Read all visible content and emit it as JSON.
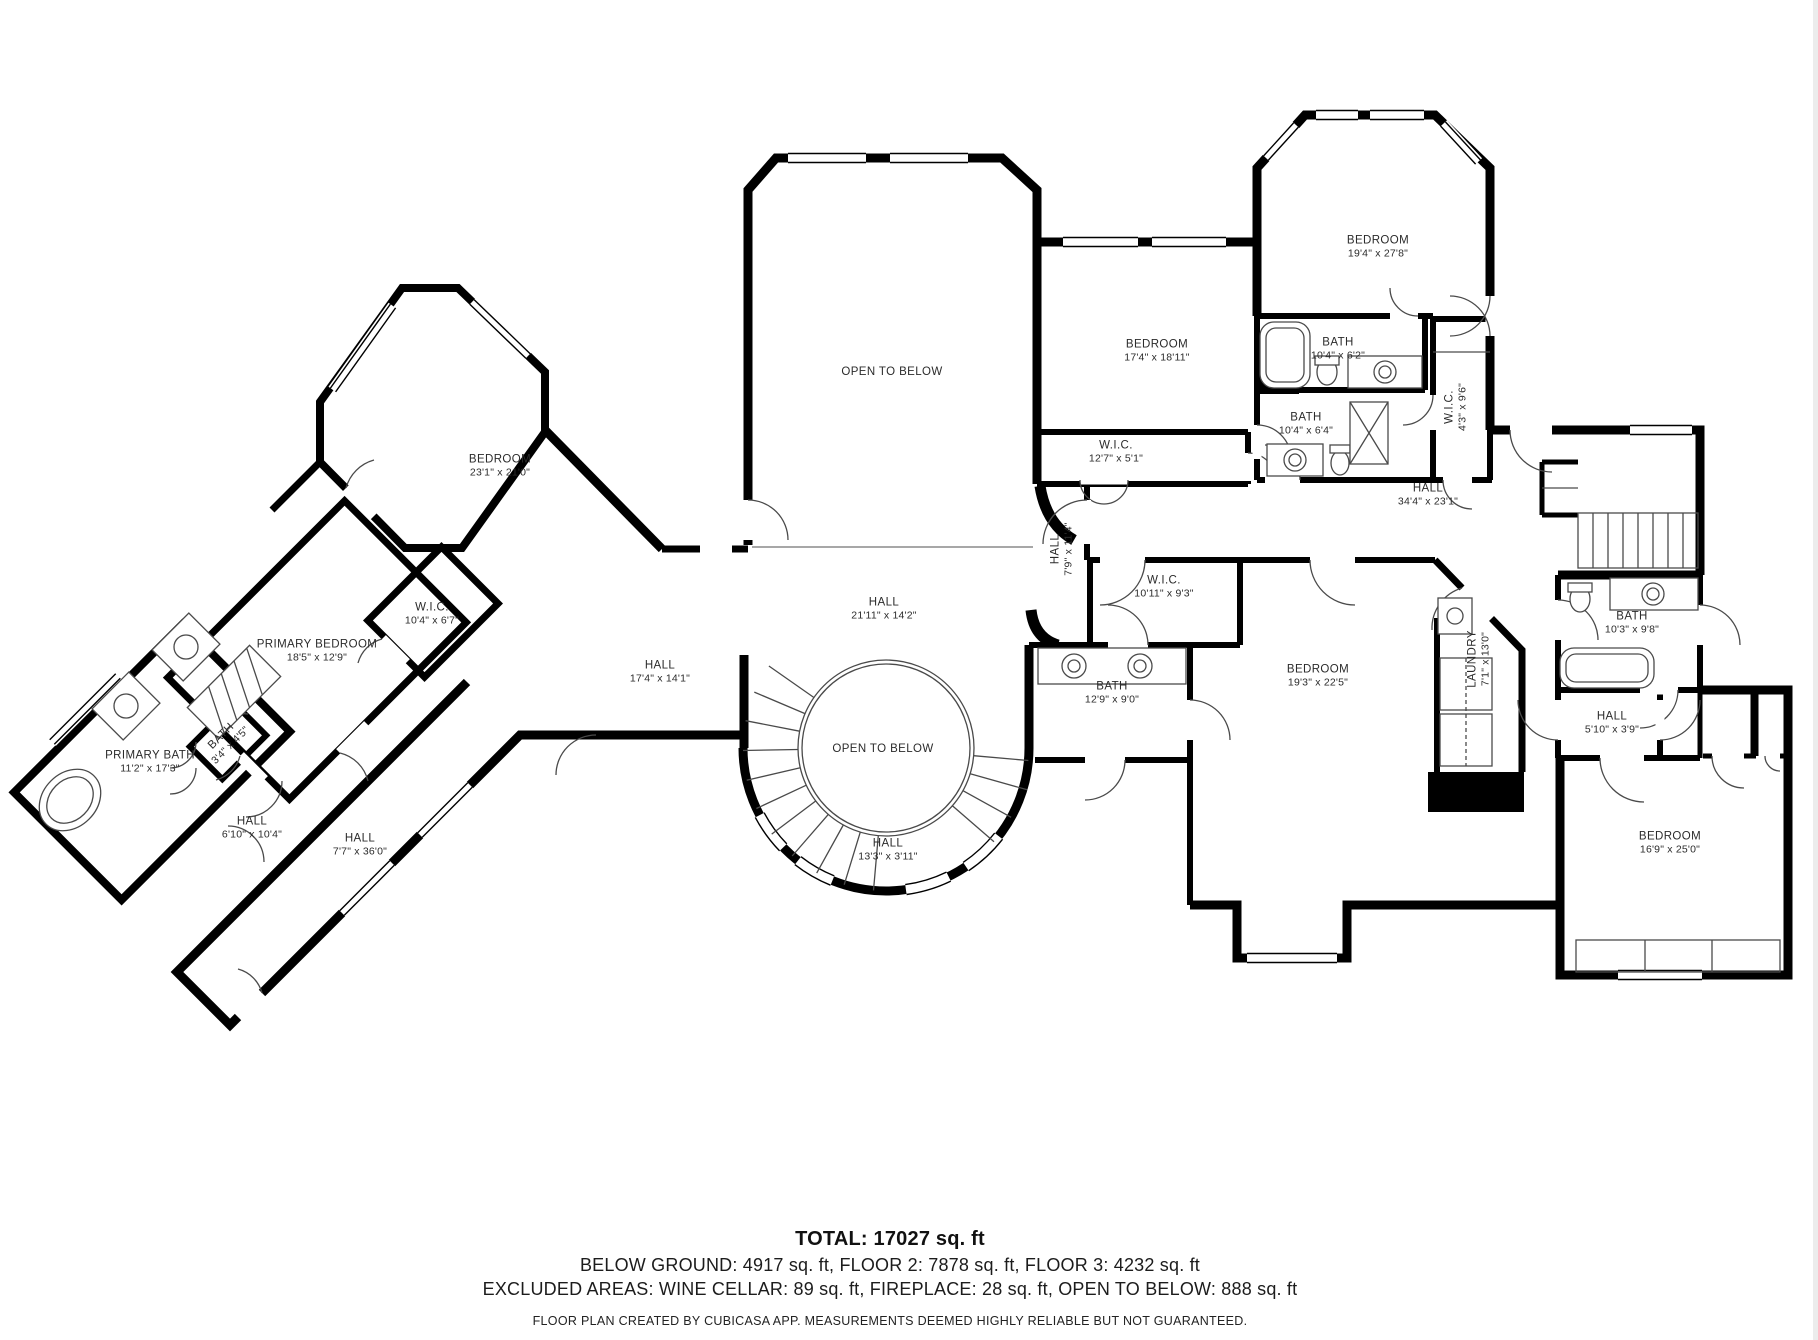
{
  "colors": {
    "wall": "#000000",
    "text": "#2b2b2b",
    "background": "#ffffff"
  },
  "footer": {
    "total": "TOTAL: 17027 sq. ft",
    "floors": "BELOW GROUND: 4917 sq. ft, FLOOR 2: 7878 sq. ft, FLOOR 3: 4232 sq. ft",
    "excluded": "EXCLUDED AREAS: WINE CELLAR: 89 sq. ft, FIREPLACE: 28 sq. ft, OPEN TO BELOW: 888 sq. ft",
    "disclaimer": "FLOOR PLAN CREATED BY CUBICASA APP. MEASUREMENTS DEEMED HIGHLY RELIABLE BUT NOT GUARANTEED."
  },
  "rooms": [
    {
      "name": "OPEN TO BELOW",
      "dims": "",
      "x": 892,
      "y": 372,
      "rot": 0
    },
    {
      "name": "BEDROOM",
      "dims": "19'4\" x 27'8\"",
      "x": 1378,
      "y": 247,
      "rot": 0
    },
    {
      "name": "BEDROOM",
      "dims": "17'4\" x 18'11\"",
      "x": 1157,
      "y": 351,
      "rot": 0
    },
    {
      "name": "BATH",
      "dims": "10'4\" x 6'2\"",
      "x": 1338,
      "y": 349,
      "rot": 0
    },
    {
      "name": "BATH",
      "dims": "10'4\" x 6'4\"",
      "x": 1306,
      "y": 424,
      "rot": 0
    },
    {
      "name": "W.I.C.",
      "dims": "4'3\" x 9'6\"",
      "x": 1456,
      "y": 407,
      "rot": -90
    },
    {
      "name": "W.I.C.",
      "dims": "12'7\" x 5'1\"",
      "x": 1116,
      "y": 452,
      "rot": 0
    },
    {
      "name": "HALL",
      "dims": "34'4\" x 23'1\"",
      "x": 1428,
      "y": 495,
      "rot": 0
    },
    {
      "name": "HALL",
      "dims": "7'9\" x 11'4\"",
      "x": 1062,
      "y": 549,
      "rot": -90
    },
    {
      "name": "W.I.C.",
      "dims": "10'11\" x 9'3\"",
      "x": 1164,
      "y": 587,
      "rot": 0
    },
    {
      "name": "BATH",
      "dims": "12'9\" x 9'0\"",
      "x": 1112,
      "y": 693,
      "rot": 0
    },
    {
      "name": "BEDROOM",
      "dims": "19'3\" x 22'5\"",
      "x": 1318,
      "y": 676,
      "rot": 0
    },
    {
      "name": "LAUNDRY",
      "dims": "7'1\" x 13'0\"",
      "x": 1479,
      "y": 659,
      "rot": -90
    },
    {
      "name": "BATH",
      "dims": "10'3\" x 9'8\"",
      "x": 1632,
      "y": 623,
      "rot": 0
    },
    {
      "name": "HALL",
      "dims": "5'10\" x 3'9\"",
      "x": 1612,
      "y": 723,
      "rot": 0
    },
    {
      "name": "BEDROOM",
      "dims": "16'9\" x 25'0\"",
      "x": 1670,
      "y": 843,
      "rot": 0
    },
    {
      "name": "BEDROOM",
      "dims": "23'1\" x 21'0\"",
      "x": 500,
      "y": 466,
      "rot": 0
    },
    {
      "name": "W.I.C.",
      "dims": "10'4\" x 6'7\"",
      "x": 432,
      "y": 614,
      "rot": 0
    },
    {
      "name": "PRIMARY BEDROOM",
      "dims": "18'5\" x 12'9\"",
      "x": 317,
      "y": 651,
      "rot": 0
    },
    {
      "name": "PRIMARY BATH",
      "dims": "11'2\" x 17'3\"",
      "x": 150,
      "y": 762,
      "rot": 0
    },
    {
      "name": "BATH",
      "dims": "3'4\" x 4'5\"",
      "x": 226,
      "y": 741,
      "rot": -45
    },
    {
      "name": "HALL",
      "dims": "6'10\" x 10'4\"",
      "x": 252,
      "y": 828,
      "rot": 0
    },
    {
      "name": "HALL",
      "dims": "7'7\" x 36'0\"",
      "x": 360,
      "y": 845,
      "rot": 0
    },
    {
      "name": "HALL",
      "dims": "17'4\" x 14'1\"",
      "x": 660,
      "y": 672,
      "rot": 0
    },
    {
      "name": "HALL",
      "dims": "21'11\" x 14'2\"",
      "x": 884,
      "y": 609,
      "rot": 0
    },
    {
      "name": "OPEN TO BELOW",
      "dims": "",
      "x": 883,
      "y": 749,
      "rot": 0
    },
    {
      "name": "HALL",
      "dims": "13'3\" x 3'11\"",
      "x": 888,
      "y": 850,
      "rot": 0
    }
  ]
}
